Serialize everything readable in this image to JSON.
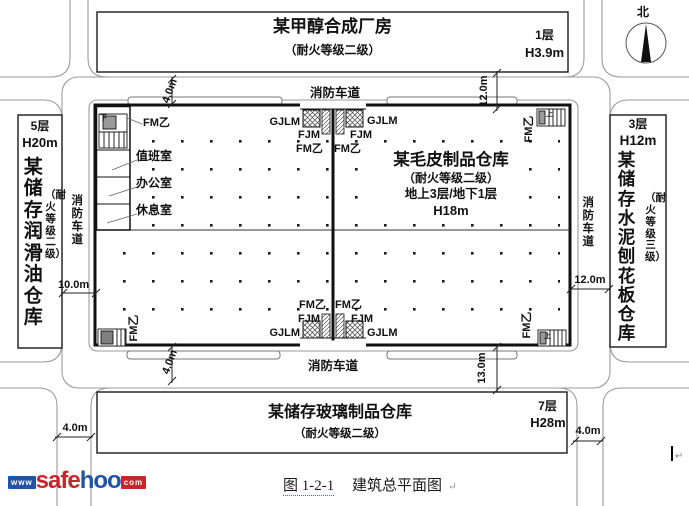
{
  "plan": {
    "north": "北",
    "fire_lane": "消防车道",
    "stair_marks": {
      "up": "上",
      "down": "下"
    },
    "top_building": {
      "name": "某甲醇合成厂房",
      "rating": "（耐火等级二级）",
      "floors": "1层",
      "height": "H3.9m"
    },
    "left_building": {
      "name": "某储存润滑油仓库",
      "rating": "（耐火等级二级）",
      "floors": "5层",
      "height": "H20m"
    },
    "right_building": {
      "name": "某储存水泥刨花板仓库",
      "rating": "（耐火等级三级）",
      "floors": "3层",
      "height": "H12m"
    },
    "bottom_building": {
      "name": "某储存玻璃制品仓库",
      "rating": "（耐火等级二级）",
      "floors": "7层",
      "height": "H28m"
    },
    "main_building": {
      "name": "某毛皮制品仓库",
      "rating": "（耐火等级二级）",
      "storeys": "地上3层/地下1层",
      "height": "H18m",
      "rooms": {
        "duty": "值班室",
        "office": "办公室",
        "rest": "休息室"
      },
      "doors": {
        "gjlm": "GJLM",
        "fjm": "FJM",
        "fm_b": "FM乙"
      }
    },
    "dims": {
      "lane_top": "4.0m",
      "gap_top_right": "12.0m",
      "gap_left": "10.0m",
      "gap_right": "12.0m",
      "gap_bottom_right": "13.0m",
      "lane_bottom": "4.0m",
      "road_bottom_left": "4.0m",
      "road_bottom_right": "4.0m"
    },
    "colors": {
      "line": "#1a1a1a",
      "road": "#9a9a9a",
      "logo_red": "#c9252c",
      "logo_blue": "#2353a4"
    }
  },
  "footer": {
    "logo": {
      "www": "www",
      "safe": "safe",
      "hoo": "hoo",
      "com": "com"
    },
    "caption_number": "图 1-2-1",
    "caption_title": "建筑总平面图",
    "paragraph_mark": "↵"
  }
}
